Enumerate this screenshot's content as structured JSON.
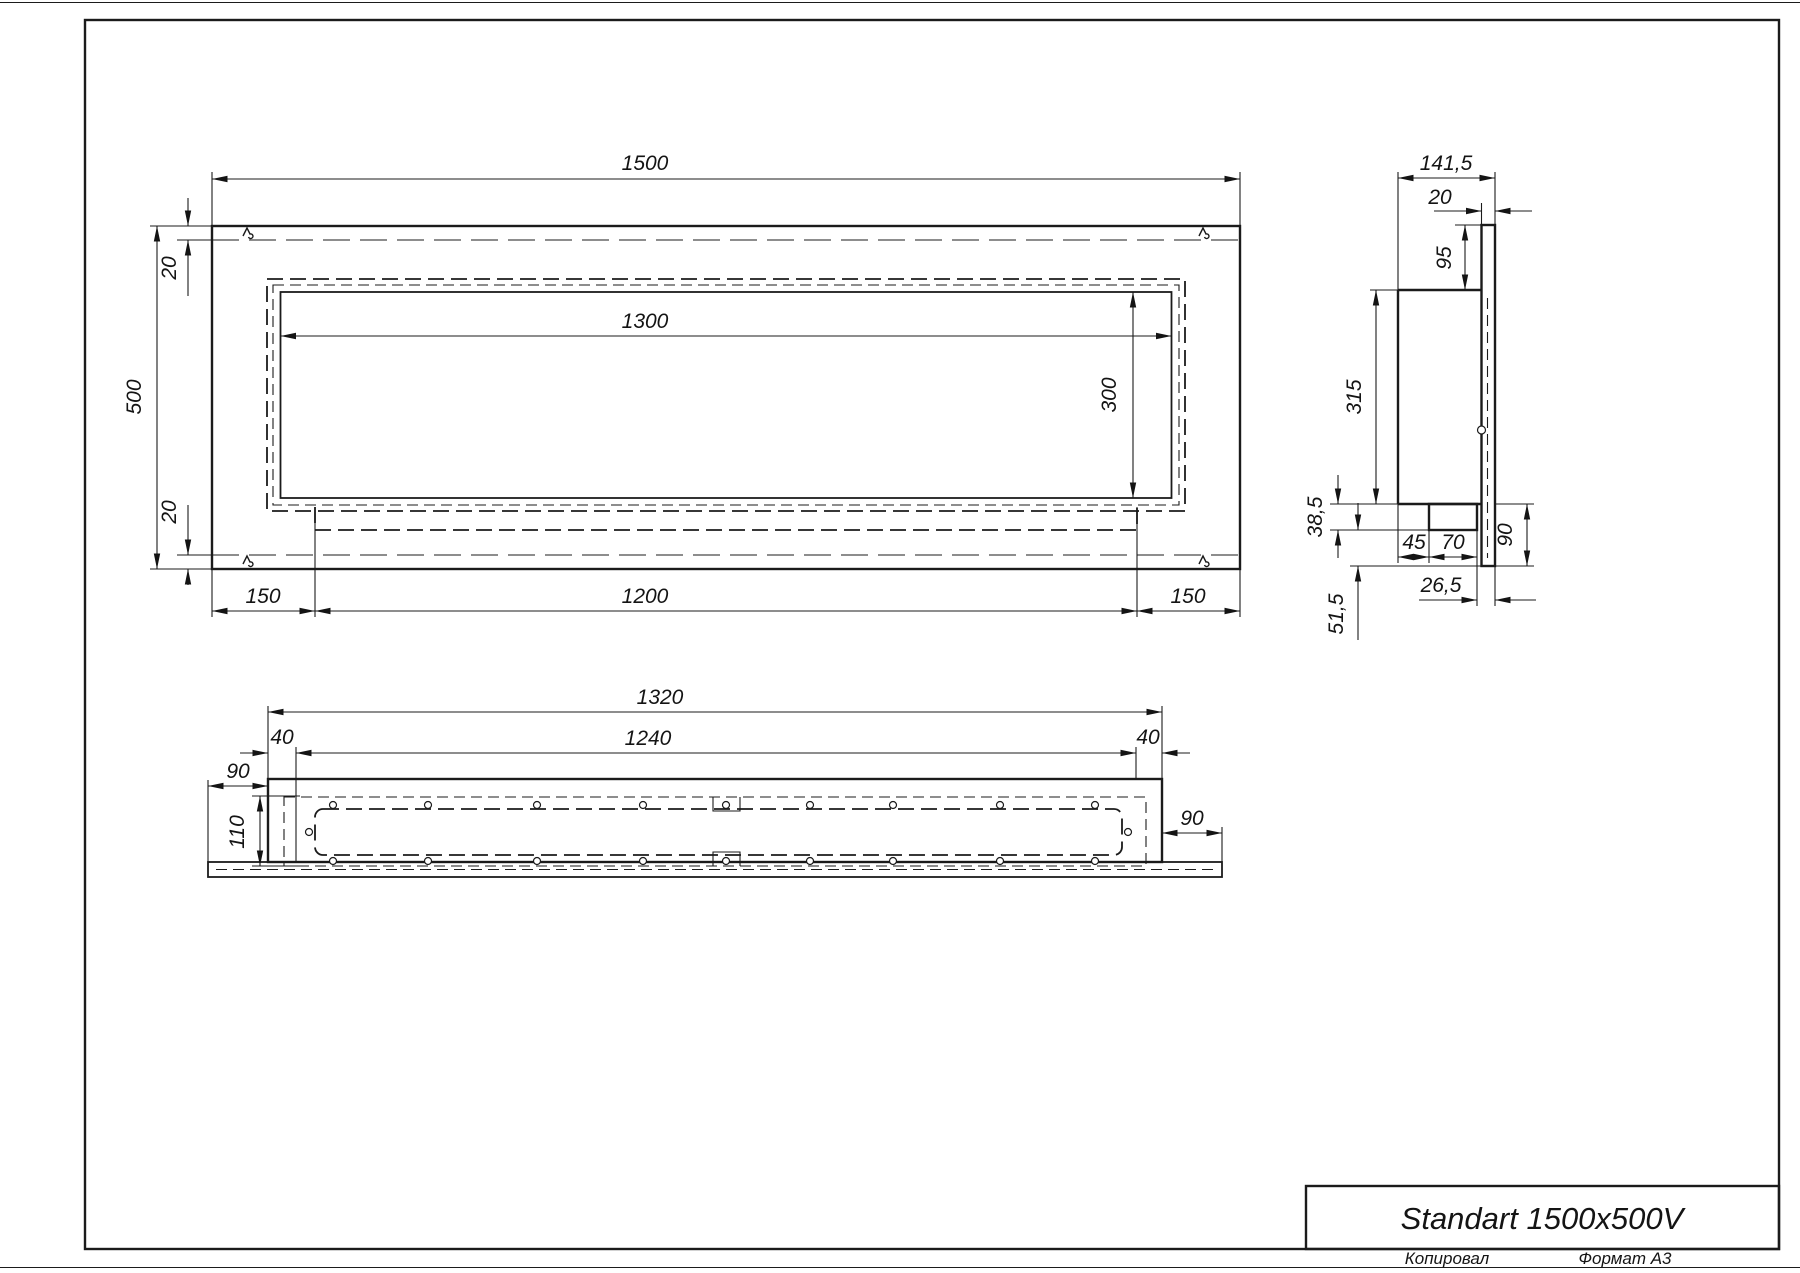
{
  "front_view": {
    "dims": {
      "overall_width": "1500",
      "overall_height": "500",
      "top_fold": "20",
      "bottom_fold": "20",
      "opening_width": "1300",
      "opening_height": "300",
      "left_offset": "150",
      "tray_width": "1200",
      "right_offset": "150"
    }
  },
  "side_view": {
    "dims": {
      "depth": "141,5",
      "front_plate_thickness": "20",
      "top_flange_height": "95",
      "body_height": "315",
      "bracket_height": "38,5",
      "bracket_offset": "45",
      "bracket_width": "70",
      "bottom_flange_height": "90",
      "rear_offset": "26,5",
      "bottom_gap": "51,5"
    }
  },
  "bottom_view": {
    "dims": {
      "body_length": "1320",
      "inner_length": "1240",
      "left_inset": "40",
      "right_inset": "40",
      "left_overhang": "90",
      "right_overhang": "90",
      "depth": "110"
    }
  },
  "title_block": {
    "title": "Standart 1500x500V",
    "copied_label": "Копировал",
    "format_label": "Формат А3"
  }
}
